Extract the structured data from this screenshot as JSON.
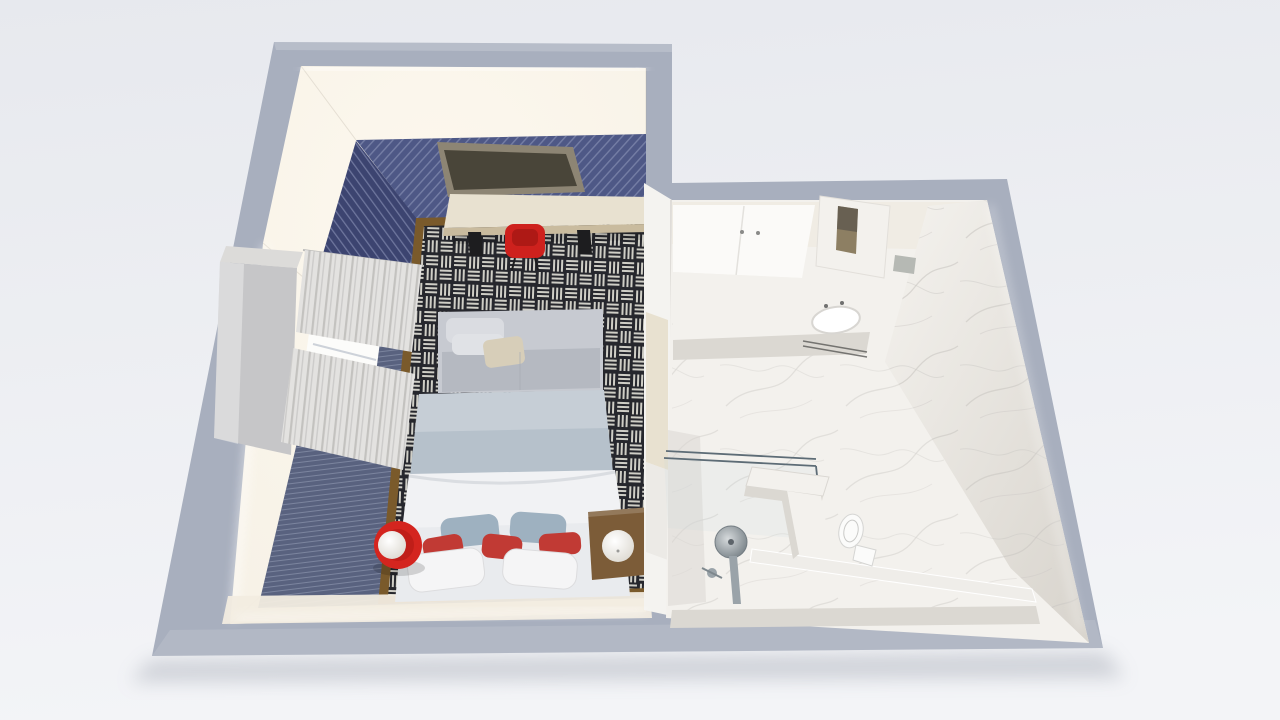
{
  "meta": {
    "description": "Photorealistic 3D cutaway (dollhouse) floor plan render of a hotel studio: navy-themed bedroom on the left, white marble bathroom on the right. No text is rendered in the image.",
    "view": "isometric top-down cutaway",
    "visible_text": "none"
  },
  "colors": {
    "background_top": "#e7e9ee",
    "background_bottom": "#f3f4f7",
    "outer_wall": "#a8afbe",
    "outer_wall_light": "#b9c0cb",
    "drop_shadow": "#8e94a1",
    "inner_white": "#f6f1e6",
    "glow_white": "#fdf8ee",
    "navy_wall": "#4e5886",
    "navy_wall_dark": "#3c4470",
    "navy_stripe": "#7e87ac",
    "navy_floor": "#59627f",
    "navy_floor_stripe": "#97a0b8",
    "rug_dark": "#26272d",
    "rug_light": "#cfcec6",
    "rug_border": "#7a5a2b",
    "wood_light": "#e8e1d0",
    "wood_mid": "#c9bb9e",
    "wood_dark": "#7c5c38",
    "leg_black": "#1d1d1f",
    "tv_frame": "#8d8574",
    "tv_screen": "#494539",
    "chair_red": "#ce211d",
    "chair_red_dark": "#a81714",
    "sofa_gray": "#c7cad1",
    "sofa_light": "#dadce1",
    "sofa_seat": "#b5b9c1",
    "pillow_beige": "#d7ceb9",
    "coverlet_blue": "#b6c1cb",
    "duvet_white": "#f1f2f4",
    "bed_base": "#e9ebee",
    "pillow_blue": "#9eb1c0",
    "pillow_red": "#c13a34",
    "pillow_white": "#f5f5f6",
    "lamp_core": "#ffffff",
    "lamp_edge": "#d9d5cc",
    "table_red": "#d4251f",
    "marble": "#f3f1ed",
    "marble_warm": "#f0ece4",
    "marble_shadow": "#dbd8d2",
    "marble_vein": "#ccc9c5",
    "marble_dark": "#c8c5c0",
    "divider_white": "#f4f3f0",
    "glass": "#bcd3da",
    "glass_frame": "#5d6c76",
    "chrome_light": "#d6dadc",
    "chrome": "#9aa3a9",
    "chrome_dark": "#6e787e",
    "toilet_white": "#fbfbfa",
    "curtain_light": "#e3e2e0",
    "curtain_dark": "#bdbcba",
    "window_white": "#fcfcfa",
    "gray_box": "#b6b9b4",
    "niche_tan": "#8d7f63",
    "niche_dark": "#54504a",
    "cream_strip": "#f2ece0"
  },
  "rooms": {
    "bedroom": {
      "label": "Bedroom",
      "walls": "navy pinstripe paneling with backlit white cornice",
      "floor": "navy carpet with black and white basketweave area rug, bronze rug border",
      "objects": [
        "wall-mounted tv panel",
        "light wood desk with black legs",
        "red desk chair",
        "gray sofa bench with cushions and beige pillow",
        "double bed",
        "blue-gray coverlet",
        "white duvet",
        "two blue-gray pillows",
        "three red accent pillows",
        "two white pillows",
        "red round side table with white sphere lamp",
        "dark wood cube nightstand with white sphere lamp",
        "window with white frame",
        "two sheer gray curtains",
        "wardrobe block"
      ]
    },
    "bathroom": {
      "label": "Bathroom",
      "walls": "white carrara marble",
      "floor": "white marble with raised platform step",
      "objects": [
        "white vanity cabinets",
        "marble counter",
        "white sink with faucet",
        "towel rail",
        "marble partition column with storage niche",
        "small gray box",
        "walk-in shower with glass screen",
        "round chrome rain shower head on riser",
        "hand shower valve",
        "marble bench",
        "marble half wall",
        "white toilet"
      ]
    },
    "divider": {
      "label": "Partition wall",
      "objects": [
        "tall light-wood cabinet"
      ]
    }
  }
}
